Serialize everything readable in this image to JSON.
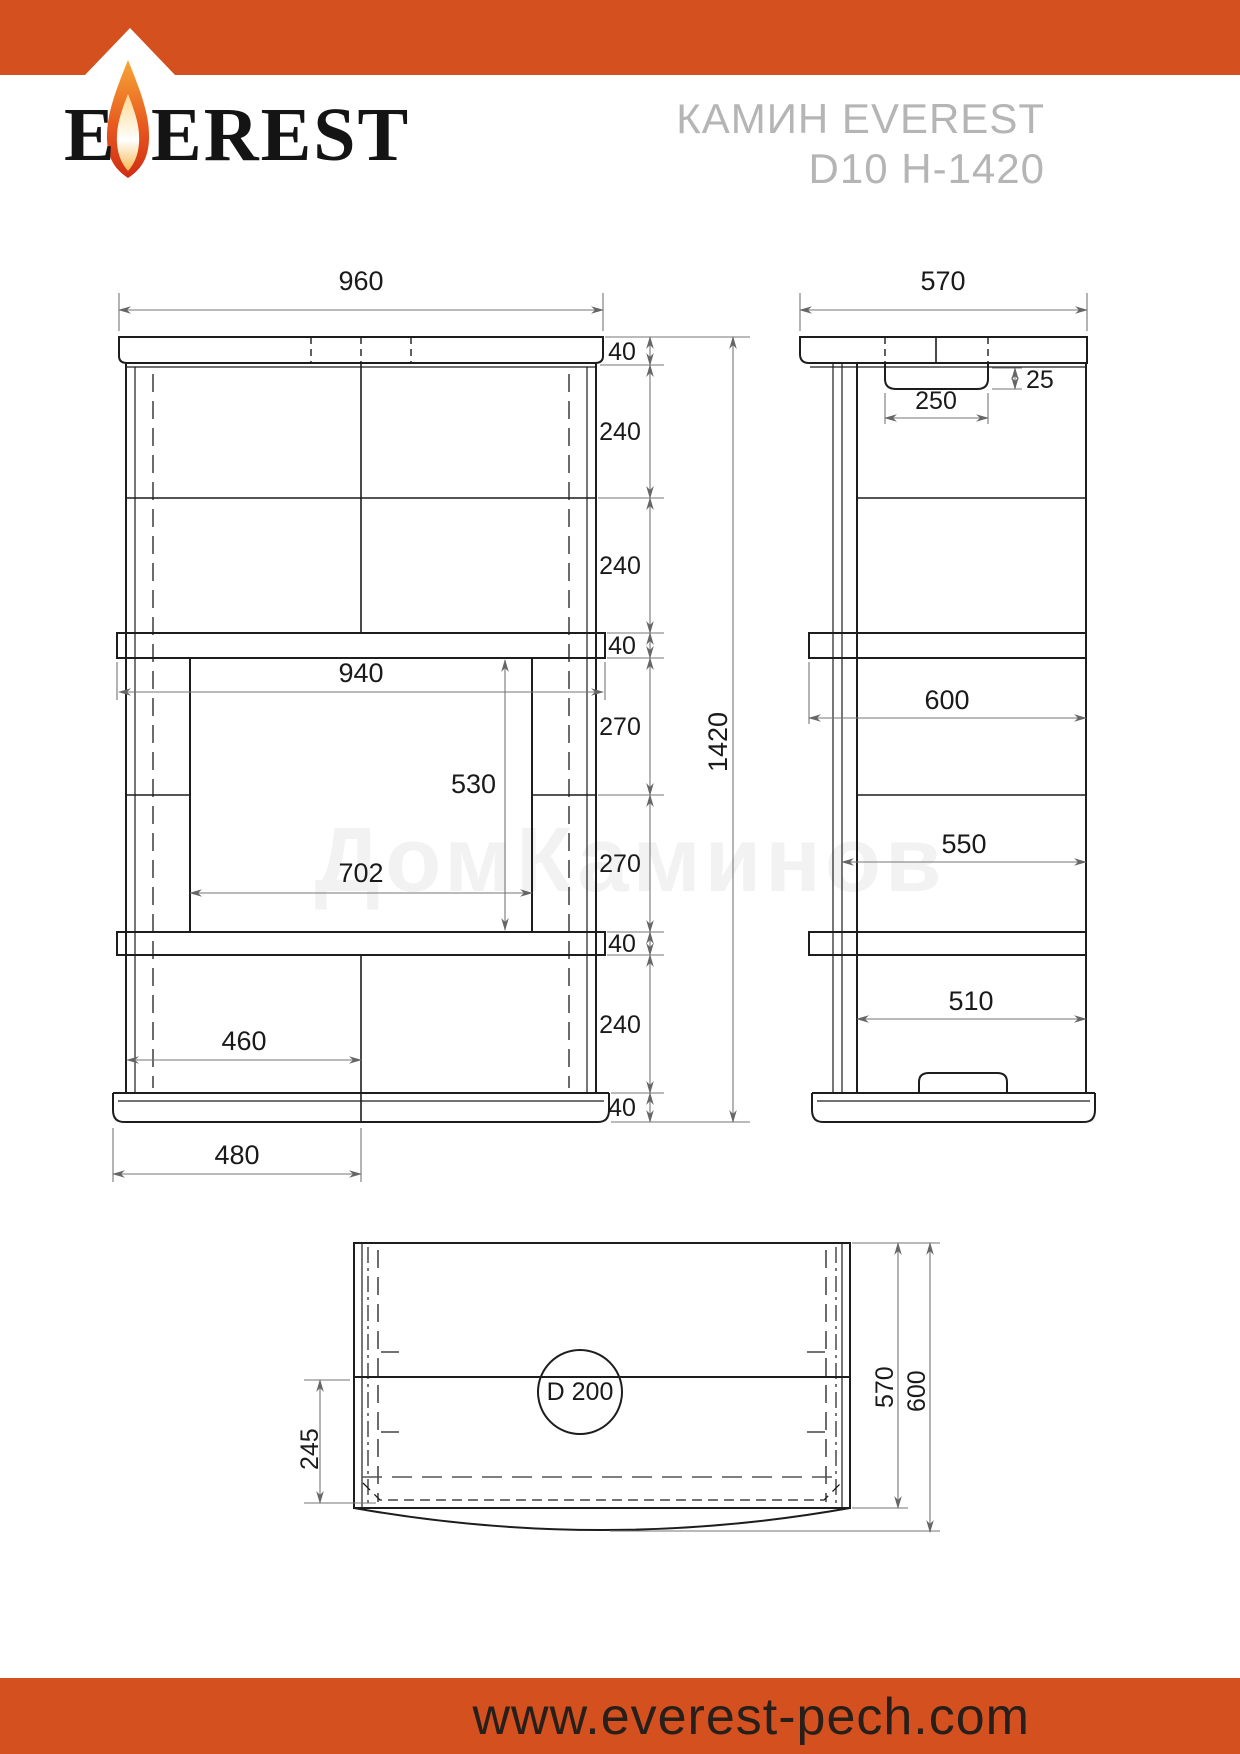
{
  "header": {
    "logo_part1": "E",
    "logo_part2": "EREST",
    "title_line1": "КАМИН EVEREST",
    "title_line2": "D10 H-1420",
    "accent_color": "#d5501f"
  },
  "watermark": {
    "text": "ДомКаминов"
  },
  "front_view": {
    "overall_width": "960",
    "cap_height": "40",
    "tier1_height": "240",
    "tier2_height": "240",
    "shelf_height": "40",
    "firebox_upper": "270",
    "firebox_lower": "270",
    "lower_shelf_height": "40",
    "plinth_tier_height": "240",
    "base_height": "40",
    "overall_height": "1420",
    "shelf_width": "940",
    "opening_height": "530",
    "opening_width": "702",
    "plinth_half_width": "460",
    "base_half_width": "480"
  },
  "side_view": {
    "overall_depth": "570",
    "vent_height": "25",
    "vent_width": "250",
    "shelf_depth": "600",
    "body_depth": "550",
    "plinth_depth": "510"
  },
  "bottom_view": {
    "flue_diameter": "D 200",
    "flue_offset": "245",
    "inner_depth": "570",
    "outer_depth": "600"
  },
  "footer": {
    "url": "www.everest-pech.com"
  }
}
